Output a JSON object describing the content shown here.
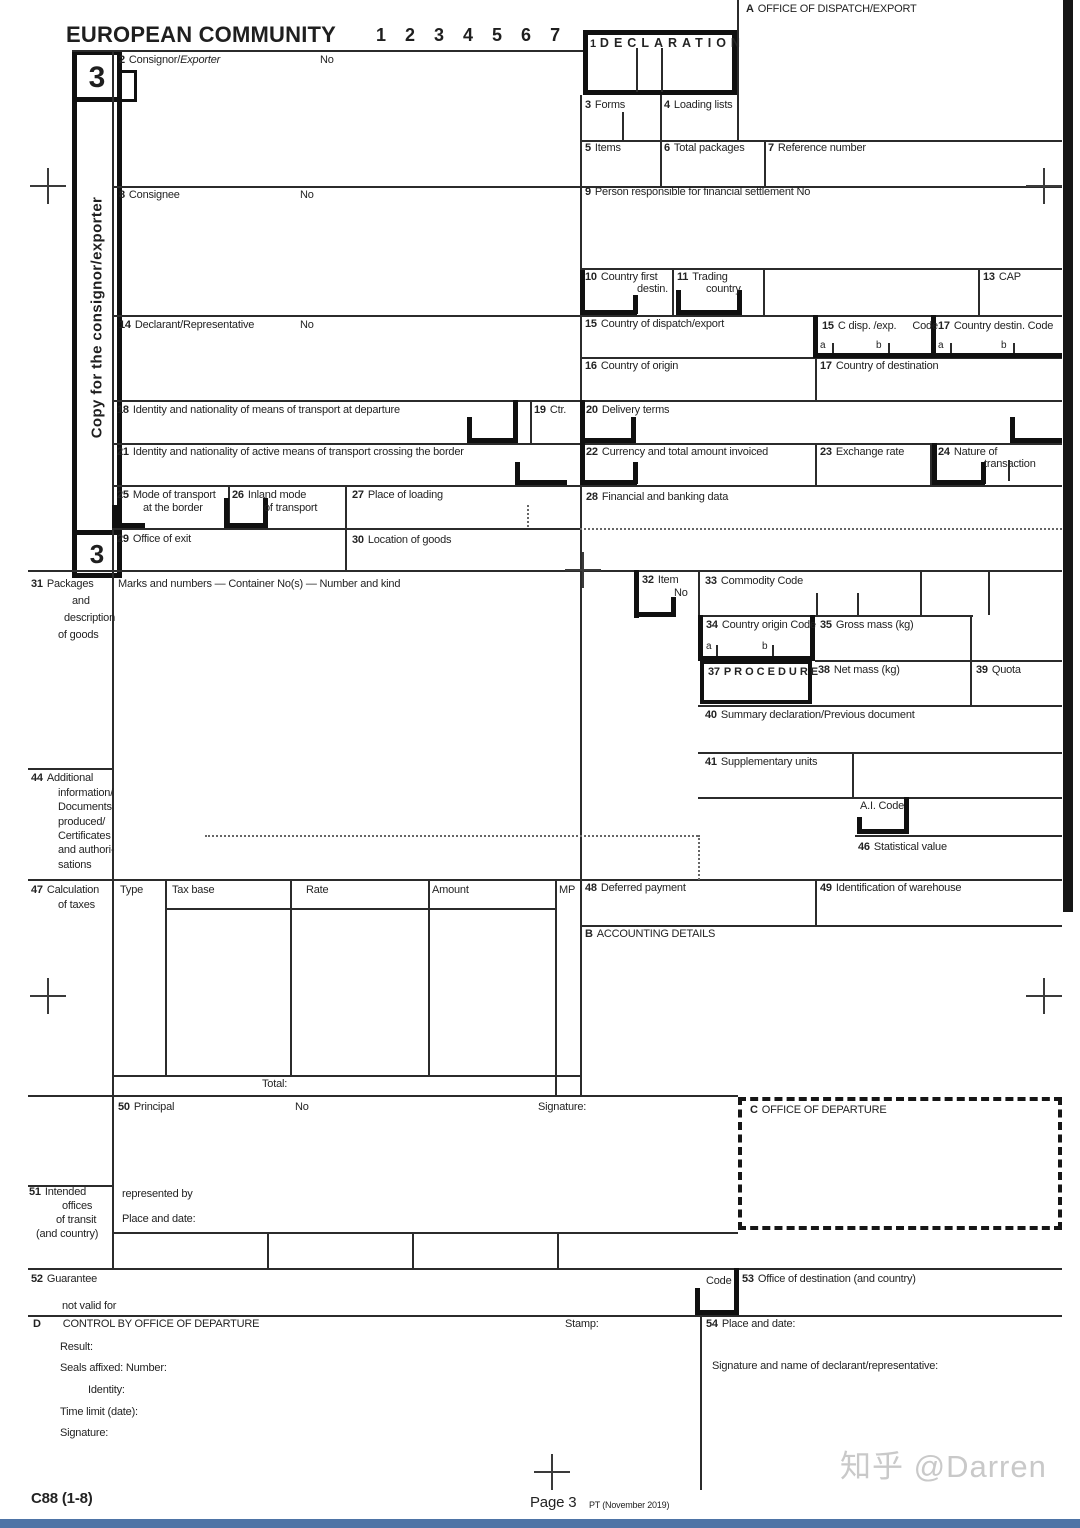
{
  "page": {
    "title": "EUROPEAN COMMUNITY",
    "copy_digits": "1 2 3 4 5 6 7",
    "copy_number": "3",
    "sidebar_text": "Copy  for the consignor/exporter",
    "office_dispatch_letter": "A",
    "office_dispatch_label": "OFFICE OF DISPATCH/EXPORT"
  },
  "b": {
    "b1": {
      "num": "1",
      "label": "DECLARATION"
    },
    "b2": {
      "num": "2",
      "label": "Consignor/",
      "italic": "Exporter",
      "no": "No"
    },
    "b3": {
      "num": "3",
      "label": "Forms"
    },
    "b4": {
      "num": "4",
      "label": "Loading lists"
    },
    "b5": {
      "num": "5",
      "label": "Items"
    },
    "b6": {
      "num": "6",
      "label": "Total packages"
    },
    "b7": {
      "num": "7",
      "label": "Reference number"
    },
    "b8": {
      "num": "8",
      "label": "Consignee",
      "no": "No"
    },
    "b9": {
      "num": "9",
      "label": "Person responsible for financial settlement No"
    },
    "b10": {
      "num": "10",
      "l1": "Country first",
      "l2": "destin."
    },
    "b11": {
      "num": "11",
      "l1": "Trading",
      "l2": "country"
    },
    "b13": {
      "num": "13",
      "label": "CAP"
    },
    "b14": {
      "num": "14",
      "label": "Declarant/Representative",
      "no": "No"
    },
    "b15": {
      "num": "15",
      "label": "Country of dispatch/export"
    },
    "b15c": {
      "num": "15",
      "label": "C disp. /exp.",
      "code": "Code",
      "a": "a",
      "b": "b"
    },
    "b17c": {
      "num": "17",
      "label": "Country destin. Code",
      "a": "a",
      "b": "b"
    },
    "b16": {
      "num": "16",
      "label": "Country of origin"
    },
    "b17": {
      "num": "17",
      "label": "Country of destination"
    },
    "b18": {
      "num": "18",
      "label": "Identity and nationality of means of transport at departure"
    },
    "b19": {
      "num": "19",
      "label": "Ctr."
    },
    "b20": {
      "num": "20",
      "label": "Delivery terms"
    },
    "b21": {
      "num": "21",
      "label": "Identity and nationality of active means of transport crossing the border"
    },
    "b22": {
      "num": "22",
      "label": "Currency and total amount invoiced"
    },
    "b23": {
      "num": "23",
      "label": "Exchange rate"
    },
    "b24": {
      "num": "24",
      "l1": "Nature of",
      "l2": "transaction"
    },
    "b25": {
      "num": "25",
      "l1": "Mode of transport",
      "l2": "at the border"
    },
    "b26": {
      "num": "26",
      "l1": "Inland mode",
      "l2": "of transport"
    },
    "b27": {
      "num": "27",
      "label": "Place of loading"
    },
    "b28": {
      "num": "28",
      "label": "Financial and banking data"
    },
    "b29": {
      "num": "29",
      "label": "Office of exit"
    },
    "b30": {
      "num": "30",
      "label": "Location of goods"
    },
    "b31": {
      "num": "31",
      "l1": "Packages",
      "l2": "and",
      "l3": "description",
      "l4": "of goods",
      "header": "Marks and numbers — Container No(s) — Number and kind"
    },
    "b32": {
      "num": "32",
      "l1": "Item",
      "l2": "No"
    },
    "b33": {
      "num": "33",
      "label": "Commodity Code"
    },
    "b34": {
      "num": "34",
      "label": "Country origin Code",
      "a": "a",
      "b": "b"
    },
    "b35": {
      "num": "35",
      "label": "Gross mass (kg)"
    },
    "b37": {
      "num": "37",
      "label": "PROCEDURE"
    },
    "b38": {
      "num": "38",
      "label": "Net mass (kg)"
    },
    "b39": {
      "num": "39",
      "label": "Quota"
    },
    "b40": {
      "num": "40",
      "label": "Summary declaration/Previous document"
    },
    "b41": {
      "num": "41",
      "label": "Supplementary units"
    },
    "ai": {
      "label": "A.I. Code"
    },
    "b46": {
      "num": "46",
      "label": "Statistical value"
    },
    "b44": {
      "num": "44",
      "l1": "Additional",
      "l2": "information/",
      "l3": "Documents",
      "l4": "produced/",
      "l5": "Certificates",
      "l6": "and authori-",
      "l7": "sations"
    },
    "b47": {
      "num": "47",
      "l1": "Calculation",
      "l2": "of taxes",
      "c1": "Type",
      "c2": "Tax base",
      "c3": "Rate",
      "c4": "Amount",
      "c5": "MP",
      "total": "Total:"
    },
    "b48": {
      "num": "48",
      "label": "Deferred payment"
    },
    "b49": {
      "num": "49",
      "label": "Identification of warehouse"
    },
    "secB": {
      "letter": "B",
      "label": "ACCOUNTING DETAILS"
    },
    "b50": {
      "num": "50",
      "label": "Principal",
      "no": "No",
      "sig": "Signature:"
    },
    "secC": {
      "letter": "C",
      "label": "OFFICE OF DEPARTURE"
    },
    "b51": {
      "num": "51",
      "l1": "Intended",
      "l2": "offices",
      "l3": "of transit",
      "l4": "(and  country)",
      "rep": "represented by",
      "pad": "Place and date:"
    },
    "b52": {
      "num": "52",
      "l1": "Guarantee",
      "l2": "not valid for",
      "code": "Code"
    },
    "b53": {
      "num": "53",
      "label": "Office of destination (and country)"
    },
    "secD": {
      "letter": "D",
      "label": "CONTROL BY OFFICE OF DEPARTURE",
      "result": "Result:",
      "seals": "Seals affixed: Number:",
      "identity": "Identity:",
      "time": "Time limit (date):",
      "sig": "Signature:",
      "stamp": "Stamp:"
    },
    "b54": {
      "num": "54",
      "label": "Place and date:",
      "sig": "Signature and name of declarant/representative:"
    }
  },
  "footer": {
    "form_code": "C88 (1-8)",
    "page": "Page 3",
    "version": "PT (November 2019)",
    "watermark": "知乎 @Darren",
    "bottom_bar_color": "#4e74a6"
  }
}
